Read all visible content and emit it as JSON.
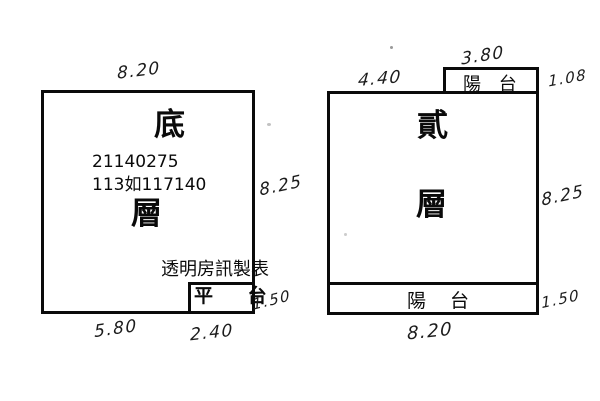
{
  "page": {
    "background": "#ffffff",
    "ink_color": "#0a0a0a",
    "handwriting_color": "#1c1c1c"
  },
  "left_plan": {
    "floor_char_top": "底",
    "floor_char_bottom": "層",
    "serial_line_1": "21140275",
    "serial_line_2": "113如117140",
    "watermark": "透明房訊製表",
    "platform_label": "平 台",
    "dim_top": "8.20",
    "dim_right": "8.25",
    "dim_bottom_left": "5.80",
    "dim_bottom_right": "2.40",
    "dim_platform": "1.50"
  },
  "right_plan": {
    "floor_char_top": "貳",
    "floor_char_bottom": "層",
    "balcony_top_label": "陽 台",
    "balcony_bottom_label": "陽 台",
    "dim_top_left": "4.40",
    "dim_balcony_top": "3.80",
    "dim_balcony_right": "1.08",
    "dim_right": "8.25",
    "dim_balcony_bottom_right": "1.50",
    "dim_bottom": "8.20"
  }
}
